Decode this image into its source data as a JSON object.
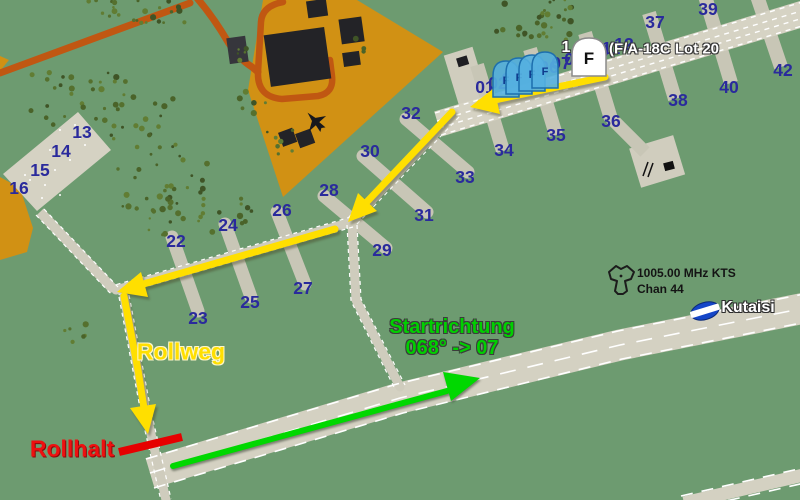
{
  "unit_label": {
    "count": "1",
    "name": "(F/A-18C Lot 20",
    "icon_letter": "F"
  },
  "parked_aircraft": {
    "icon_letter": "F",
    "count": 4
  },
  "annotations": {
    "taxi_label": "Rollweg",
    "hold_label": "Rollhalt",
    "takeoff_label_line1": "Startrichtung",
    "takeoff_label_line2": "068° -> 07"
  },
  "beacon": {
    "freq": "1005.00 MHz KTS",
    "channel": "Chan 44"
  },
  "airport": {
    "name": "Kutaisi"
  },
  "parking_spots": [
    {
      "n": "01",
      "x": 485,
      "y": 87
    },
    {
      "n": "02",
      "x": 498,
      "y": 83
    },
    {
      "n": "03",
      "x": 511,
      "y": 79
    },
    {
      "n": "04",
      "x": 523,
      "y": 75
    },
    {
      "n": "05",
      "x": 536,
      "y": 71
    },
    {
      "n": "06",
      "x": 549,
      "y": 67
    },
    {
      "n": "07",
      "x": 561,
      "y": 63
    },
    {
      "n": "08",
      "x": 574,
      "y": 59
    },
    {
      "n": "09",
      "x": 587,
      "y": 55
    },
    {
      "n": "10",
      "x": 599,
      "y": 51
    },
    {
      "n": "11",
      "x": 611,
      "y": 48
    },
    {
      "n": "12",
      "x": 624,
      "y": 44
    },
    {
      "n": "13",
      "x": 82,
      "y": 132
    },
    {
      "n": "14",
      "x": 61,
      "y": 151
    },
    {
      "n": "15",
      "x": 40,
      "y": 170
    },
    {
      "n": "16",
      "x": 19,
      "y": 188
    },
    {
      "n": "22",
      "x": 176,
      "y": 241
    },
    {
      "n": "23",
      "x": 198,
      "y": 318
    },
    {
      "n": "24",
      "x": 228,
      "y": 225
    },
    {
      "n": "25",
      "x": 250,
      "y": 302
    },
    {
      "n": "26",
      "x": 282,
      "y": 210
    },
    {
      "n": "27",
      "x": 303,
      "y": 288
    },
    {
      "n": "28",
      "x": 329,
      "y": 190
    },
    {
      "n": "29",
      "x": 382,
      "y": 250
    },
    {
      "n": "30",
      "x": 370,
      "y": 151
    },
    {
      "n": "31",
      "x": 424,
      "y": 215
    },
    {
      "n": "32",
      "x": 411,
      "y": 113
    },
    {
      "n": "33",
      "x": 465,
      "y": 177
    },
    {
      "n": "34",
      "x": 504,
      "y": 150
    },
    {
      "n": "35",
      "x": 556,
      "y": 135
    },
    {
      "n": "36",
      "x": 611,
      "y": 121
    },
    {
      "n": "37",
      "x": 655,
      "y": 22
    },
    {
      "n": "38",
      "x": 678,
      "y": 100
    },
    {
      "n": "39",
      "x": 708,
      "y": 9
    },
    {
      "n": "40",
      "x": 729,
      "y": 87
    },
    {
      "n": "42",
      "x": 783,
      "y": 70
    }
  ],
  "colors": {
    "taxi_route": "#ffdf00",
    "hold_short": "#e60000",
    "takeoff_direction": "#00d800",
    "parking_number": "#2a2a9c",
    "grass": "#6d9b70",
    "apron_orange": "#d19114",
    "road_orange": "#c05712"
  }
}
